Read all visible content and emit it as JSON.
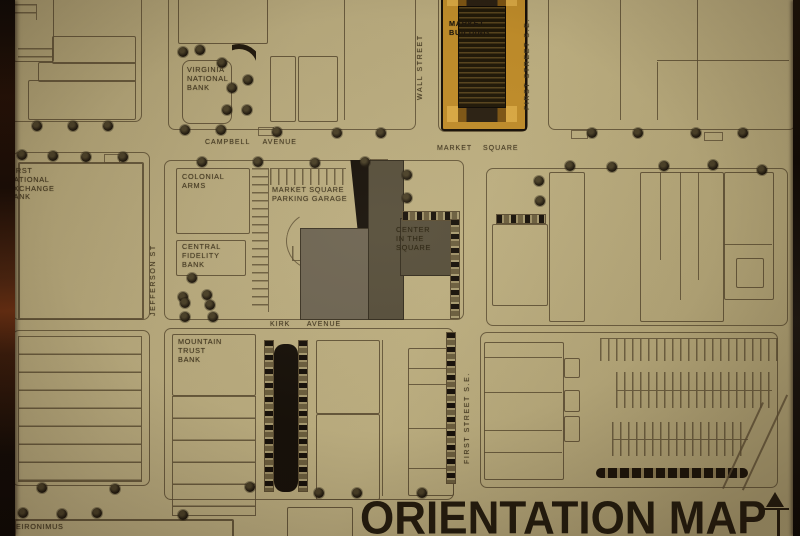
{
  "title": "ORIENTATION MAP",
  "streets": {
    "campbell": "CAMPBELL AVENUE",
    "market_square": "MARKET SQUARE",
    "kirk": "KIRK AVENUE",
    "jefferson": "JEFFERSON ST",
    "wall": "WALL STREET",
    "first_se_top": "FIRST STREET S.E.",
    "first_se_bottom": "FIRST STREET S.E."
  },
  "buildings": {
    "virginia_national_bank": "VIRGINIA\nNATIONAL\nBANK",
    "market_building": "MARKET\nBUILDING",
    "first_national_exchange_bank": "FIRST\nNATIONAL\nEXCHANGE\nBANK",
    "colonial_arms": "COLONIAL\nARMS",
    "parking_garage": "MARKET SQUARE\nPARKING GARAGE",
    "central_fidelity_bank": "CENTRAL\nFIDELITY\nBANK",
    "center_in_the_square": "CENTER\nIN THE\nSQUARE",
    "mountain_trust_bank": "MOUNTAIN\nTRUST\nBANK",
    "heironimus": "HEIRONIMUS"
  },
  "colors": {
    "paper": "#b2a478",
    "line": "#5c4e33",
    "ink": "#40351e",
    "dark": "#17110a",
    "gold": "#bf8c2a",
    "gold_light": "#d9a843",
    "gold_dark": "#7d5514",
    "garage_gray": "#6d6452",
    "center_gray": "#564e3b",
    "tree": "#221a0e",
    "title_ink": "#241c0e",
    "border_brown": "#1a0f08"
  }
}
